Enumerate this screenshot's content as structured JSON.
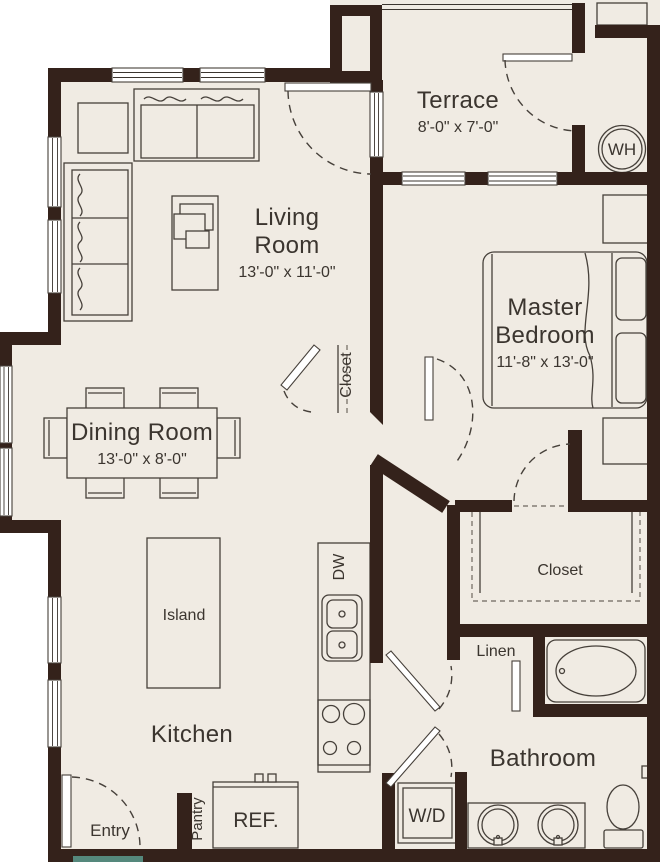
{
  "floorplan": {
    "rooms": {
      "living_room": {
        "name_line1": "Living",
        "name_line2": "Room",
        "dimensions": "13'-0\" x 11'-0\""
      },
      "dining_room": {
        "name": "Dining Room",
        "dimensions": "13'-0\" x 8'-0\""
      },
      "kitchen": {
        "name": "Kitchen"
      },
      "terrace": {
        "name": "Terrace",
        "dimensions": "8'-0\" x 7'-0\""
      },
      "master_bedroom": {
        "name_line1": "Master",
        "name_line2": "Bedroom",
        "dimensions": "11'-8\" x 13'-0\""
      },
      "bathroom": {
        "name": "Bathroom"
      },
      "entry": {
        "name": "Entry"
      }
    },
    "storage": {
      "master_closet": "Closet",
      "coat_closet": "Closet",
      "linen": "Linen",
      "pantry": "Pantry"
    },
    "kitchen_features": {
      "island": "Island",
      "dishwasher": "DW",
      "refrigerator": "REF."
    },
    "utilities": {
      "water_heater": "WH",
      "washer_dryer": "W/D"
    },
    "colors": {
      "wall": "#34221b",
      "floor": "#f0ebe3",
      "line": "#46403a",
      "text": "#3b352f",
      "entry_threshold": "#55887c"
    }
  }
}
